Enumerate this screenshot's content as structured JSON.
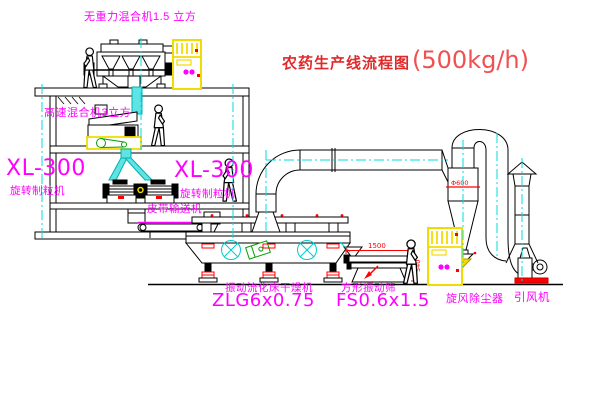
{
  "title": {
    "text": "农药生产线流程图",
    "capacity": "(500kg/h)"
  },
  "equipment_labels": {
    "gravity_free_mixer": "无重力混合机1.5 立方",
    "high_speed_mixer": "高速混合机3立方",
    "granulator_left_model": "XL-300",
    "granulator_left_name": "旋转制粒机",
    "granulator_right_model": "XL-300",
    "granulator_right_name": "旋转制粒机",
    "belt_conveyor": "皮带输送机",
    "fluid_bed_dryer_name": "振动流化床干燥机",
    "fluid_bed_dryer_model": "ZLG6x0.75",
    "vibrating_sieve_name": "方形振动筛",
    "vibrating_sieve_model": "FS0.6x1.5",
    "cyclone_dust_collector": "旋风除尘器",
    "induced_draft_fan": "引风机"
  },
  "dimensions": {
    "sieve_length": "1500",
    "sieve_height": "540",
    "cyclone_diameter": "Φ600"
  },
  "colors": {
    "label_magenta": "#ff00ff",
    "title_red": "#e02a2a",
    "drawing_black": "#000000",
    "centerline_cyan": "#00dede",
    "equipment_yellow": "#f2dc00",
    "alert_red": "#ff0000",
    "detail_green": "#00a000"
  }
}
